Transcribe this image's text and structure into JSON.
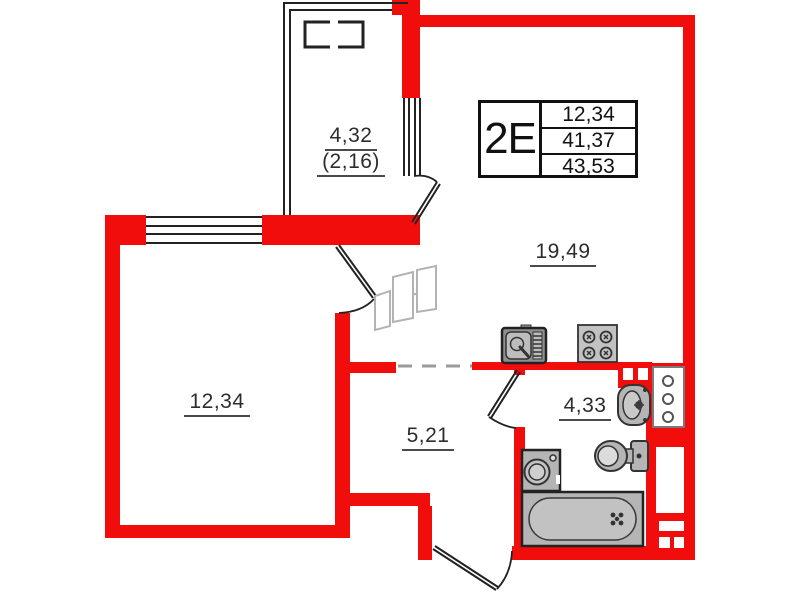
{
  "plan_type": "apartment-floor-plan",
  "info_table": {
    "type_label": "2E",
    "values": [
      "12,34",
      "41,37",
      "43,53"
    ]
  },
  "rooms": {
    "living": "19,49",
    "bedroom": "12,34",
    "hall": "5,21",
    "bathroom": "4,33",
    "balcony": "4,32",
    "balcony_reduced": "(2,16)"
  },
  "icons": [
    "kitchen-sink-icon",
    "stove-icon",
    "washbasin-icon",
    "toilet-icon",
    "washing-machine-icon",
    "bathtub-icon",
    "riser-shaft-icon",
    "wardrobe-sketch-icon"
  ],
  "colors": {
    "wall_red": "#f20d0d",
    "line_black": "#222222",
    "fixture_gray": "#b5b5b5",
    "dash_gray": "#9a9a9a"
  }
}
